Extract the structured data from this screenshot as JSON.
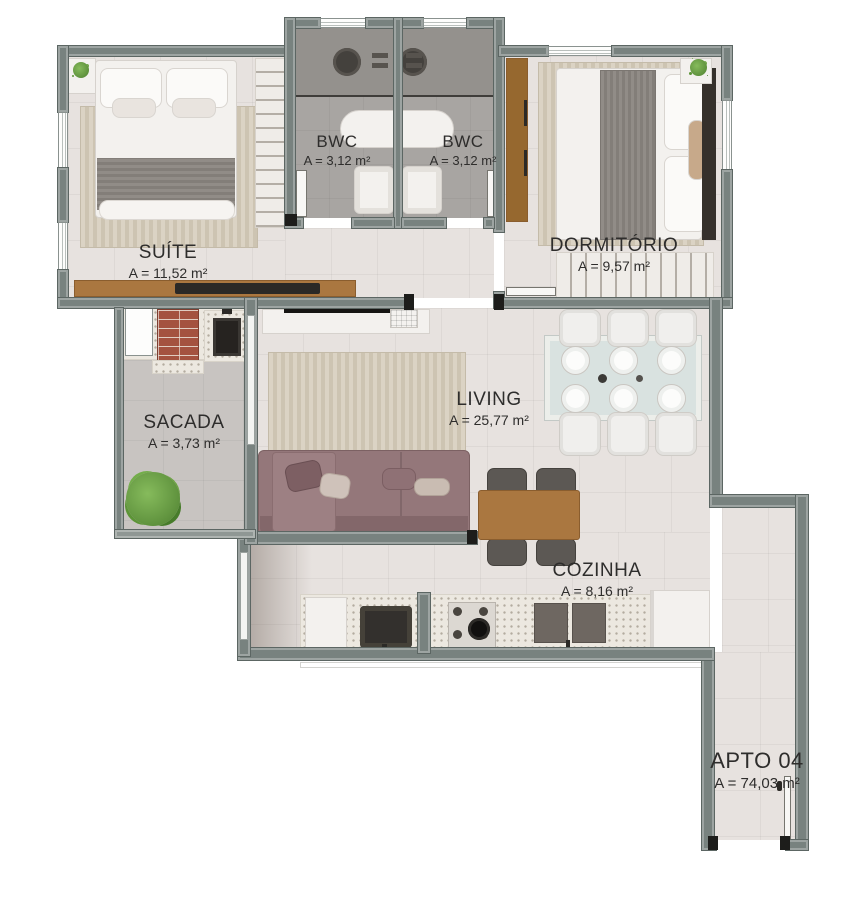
{
  "plan_title": "Apartment floor plan",
  "rooms": {
    "suite": {
      "label": "SUÍTE",
      "area": "A = 11,52 m²"
    },
    "bwc1": {
      "label": "BWC",
      "area": "A = 3,12 m²"
    },
    "bwc2": {
      "label": "BWC",
      "area": "A = 3,12 m²"
    },
    "dormitorio": {
      "label": "DORMITÓRIO",
      "area": "A = 9,57 m²"
    },
    "sacada": {
      "label": "SACADA",
      "area": "A = 3,73 m²"
    },
    "living": {
      "label": "LIVING",
      "area": "A = 25,77 m²"
    },
    "cozinha": {
      "label": "COZINHA",
      "area": "A = 8,16 m²"
    },
    "apto": {
      "label": "APTO 04",
      "area": "A = 74,03 m²"
    }
  },
  "colors": {
    "wall": "#78827f",
    "floor_light": "#e7e2df",
    "floor_bwc": "#a8a5a2",
    "floor_balcony": "#c8c4c1",
    "wood": "#aa7740",
    "sofa": "#94777a",
    "plant_green": "#6fa84e",
    "brick": "#a4523f",
    "text": "#2e2d2c"
  }
}
